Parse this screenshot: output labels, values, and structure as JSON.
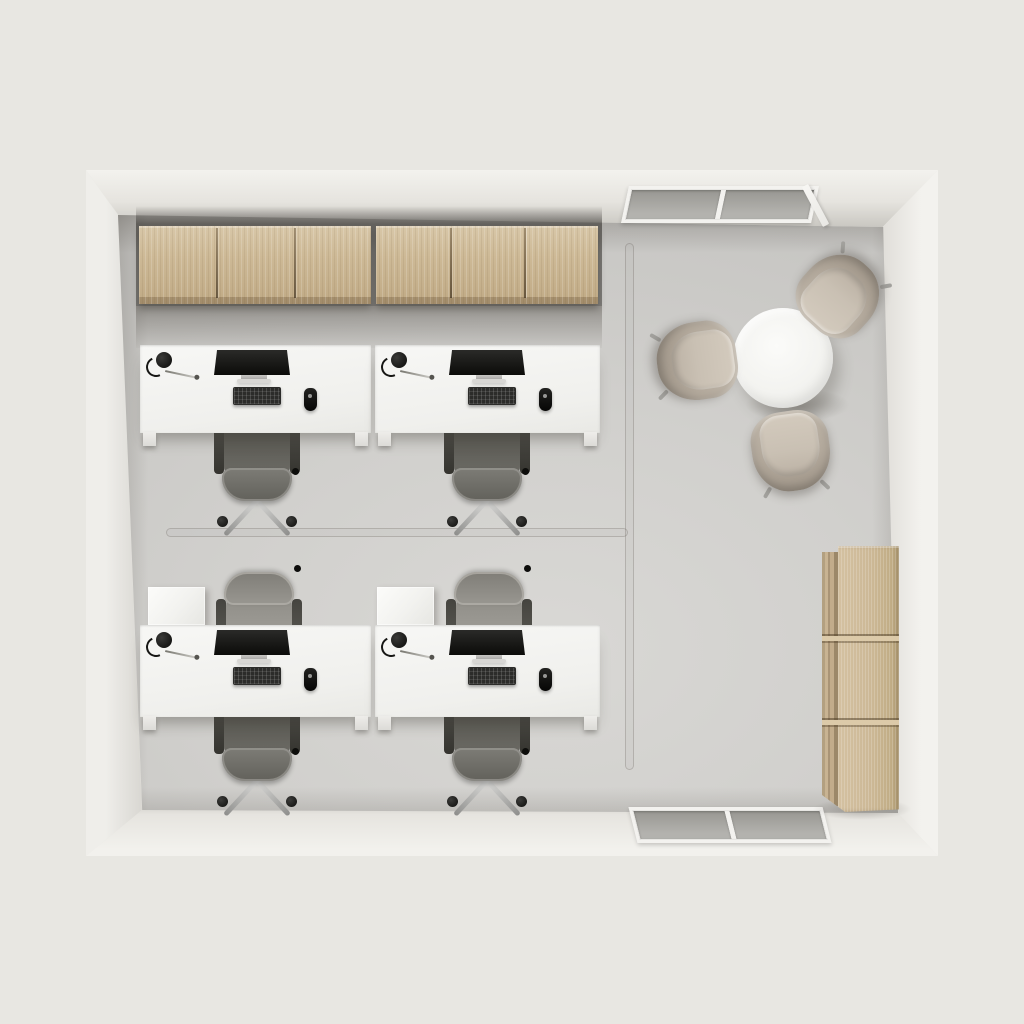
{
  "palette": {
    "background": "#e8e7e2",
    "wall": "#f2f1ed",
    "floor": "#d0cfcc",
    "wood": "#ccb795",
    "wood_dark": "#b49e7c",
    "desk_white": "#f5f5f3",
    "chair_dark": "#605f5a",
    "chair_light": "#9b9994",
    "lounge_shell": "#b2a89b",
    "lounge_cushion": "#cdc4b7",
    "glass": "#a9a8a4",
    "chrome": "#c0c0be",
    "device_black": "#181816"
  },
  "scene": {
    "items": [
      {
        "name": "cabinet-wall-shadow",
        "type": "shadow",
        "variant": "cab-wall",
        "x": 136,
        "y": 206,
        "w": 466,
        "h": 100
      },
      {
        "name": "upper-cabinet-left",
        "type": "cabinet",
        "x": 139,
        "y": 226,
        "w": 232,
        "h": 78,
        "doors": 3
      },
      {
        "name": "upper-cabinet-right",
        "type": "cabinet",
        "x": 376,
        "y": 226,
        "w": 222,
        "h": 78,
        "doors": 3
      },
      {
        "name": "cabinet-floor-shadow",
        "type": "shadow",
        "variant": "cab-floor",
        "x": 136,
        "y": 306,
        "w": 466,
        "h": 42
      },
      {
        "name": "window-top",
        "type": "window",
        "x": 625,
        "y": 186,
        "w": 190,
        "h": 37,
        "skew": -12,
        "panes": 2
      },
      {
        "name": "window-top-flap",
        "type": "window-flap",
        "x": 812,
        "y": 183,
        "w": 7,
        "h": 45,
        "rot": -28
      },
      {
        "name": "window-bottom",
        "type": "window",
        "x": 633,
        "y": 807,
        "w": 194,
        "h": 36,
        "skew": 14,
        "panes": 2
      },
      {
        "name": "floor-seam-vertical",
        "type": "seam",
        "x": 625,
        "y": 243,
        "w": 9,
        "h": 527
      },
      {
        "name": "floor-seam-horizontal",
        "type": "seam",
        "x": 166,
        "y": 528,
        "w": 462,
        "h": 9
      },
      {
        "name": "meeting-table-shadow",
        "type": "shadow",
        "variant": "ellipse",
        "x": 745,
        "y": 388,
        "w": 105,
        "h": 34
      },
      {
        "name": "meeting-table",
        "type": "mtable",
        "x": 733,
        "y": 308,
        "w": 100,
        "h": 100
      },
      {
        "name": "lounge-chair-north",
        "type": "lounge",
        "x": 800,
        "y": 255,
        "w": 78,
        "h": 80,
        "rot": 222
      },
      {
        "name": "lounge-chair-west",
        "type": "lounge",
        "x": 658,
        "y": 321,
        "w": 78,
        "h": 80,
        "rot": 82
      },
      {
        "name": "lounge-chair-south",
        "type": "lounge",
        "x": 752,
        "y": 411,
        "w": 78,
        "h": 80,
        "rot": -8
      },
      {
        "name": "tall-cabinet-shadow",
        "type": "shadow",
        "variant": "ellipse",
        "x": 812,
        "y": 798,
        "w": 100,
        "h": 22
      },
      {
        "name": "tall-cabinet",
        "type": "tcab",
        "x": 822,
        "y": 546,
        "w": 77,
        "h": 266
      },
      {
        "name": "pedestal-cube-1",
        "type": "cube",
        "x": 148,
        "y": 587,
        "w": 57,
        "h": 38
      },
      {
        "name": "pedestal-cube-2",
        "type": "cube",
        "x": 377,
        "y": 587,
        "w": 57,
        "h": 38
      },
      {
        "name": "task-chair-1",
        "type": "chair",
        "facing": "n",
        "x": 214,
        "y": 424,
        "w": 86,
        "h": 104
      },
      {
        "name": "task-chair-2",
        "type": "chair",
        "facing": "n",
        "x": 444,
        "y": 424,
        "w": 86,
        "h": 104
      },
      {
        "name": "visitor-chair-1",
        "type": "chair",
        "facing": "s",
        "x": 216,
        "y": 545,
        "w": 86,
        "h": 104
      },
      {
        "name": "visitor-chair-2",
        "type": "chair",
        "facing": "s",
        "x": 446,
        "y": 545,
        "w": 86,
        "h": 104
      },
      {
        "name": "task-chair-3",
        "type": "chair",
        "facing": "n",
        "x": 214,
        "y": 704,
        "w": 86,
        "h": 104
      },
      {
        "name": "task-chair-4",
        "type": "chair",
        "facing": "n",
        "x": 444,
        "y": 704,
        "w": 86,
        "h": 104
      },
      {
        "name": "desk-1",
        "type": "desk",
        "x": 140,
        "y": 345,
        "w": 231,
        "h": 88
      },
      {
        "name": "desk-2",
        "type": "desk",
        "x": 375,
        "y": 345,
        "w": 225,
        "h": 88
      },
      {
        "name": "desk-3",
        "type": "desk",
        "x": 140,
        "y": 625,
        "w": 231,
        "h": 92
      },
      {
        "name": "desk-4",
        "type": "desk",
        "x": 375,
        "y": 625,
        "w": 225,
        "h": 92
      }
    ]
  }
}
